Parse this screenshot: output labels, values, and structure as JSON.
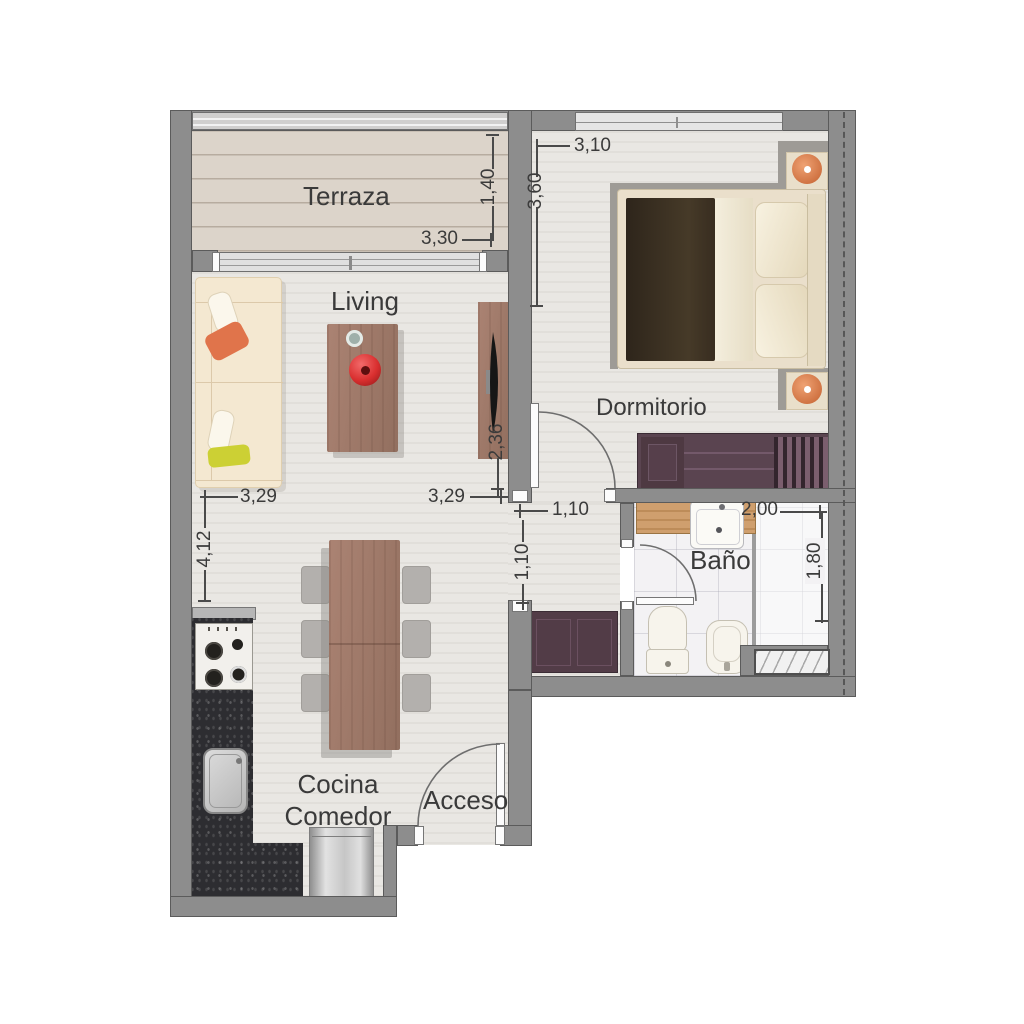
{
  "rooms": {
    "terraza": {
      "label": "Terraza"
    },
    "living": {
      "label": "Living"
    },
    "dormitorio": {
      "label": "Dormitorio"
    },
    "bano": {
      "label": "Baño"
    },
    "cocina_comedor": {
      "label_line1": "Cocina",
      "label_line2": "Comedor"
    },
    "acceso": {
      "label": "Acceso"
    }
  },
  "dimensions": {
    "terraza_width": "3,30",
    "terraza_depth": "1,40",
    "dormitorio_width": "3,10",
    "dormitorio_depth": "3,60",
    "living_sofa_wall": "3,29",
    "living_depth": "4,12",
    "living_tv_wall": "3,29",
    "tv_unit_length": "2,36",
    "hall_doorway": "1,10",
    "hall_passage": "1,10",
    "bano_width": "2,00",
    "bano_depth": "1,80"
  },
  "colors": {
    "wall": "#8d8d8d",
    "wall_outline": "#5b5b5b",
    "floor": "#e9e7e3",
    "terraza_floor": "#dcd4ca",
    "bathroom_floor": "#f3f2f4",
    "kitchen_counter": "#2d2d31",
    "wood": "#a07868",
    "vanity_wood": "#c6975f",
    "wardrobe_plum": "#5a4450",
    "bed_blanket": "#362c21",
    "accent_orange": "#d9794b",
    "sofa_cream": "#f4e8d1",
    "pillow_yellow": "#ccd034",
    "vase_red": "#d93434",
    "dimension_text": "#3b3b3b"
  }
}
